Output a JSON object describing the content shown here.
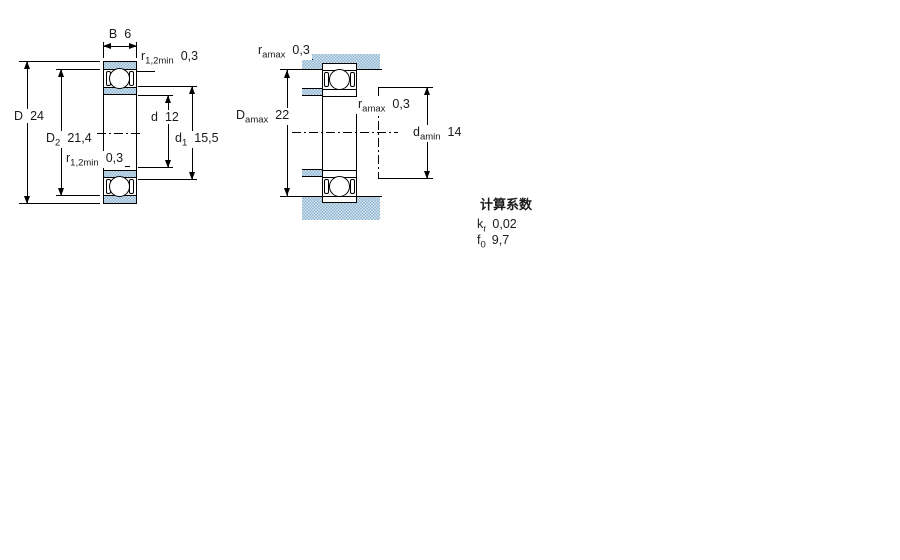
{
  "left_diagram": {
    "description": "bearing cross-section with shields",
    "width_label": {
      "sym": "B",
      "value": "6"
    },
    "outer_diameter": {
      "sym": "D",
      "value": "24"
    },
    "shoulder_diameter": {
      "sym": "D",
      "sub": "2",
      "value": "21,4"
    },
    "bore_diameter": {
      "sym": "d",
      "value": "12"
    },
    "recess_diameter": {
      "sym": "d",
      "sub": "1",
      "value": "15,5"
    },
    "fillet_top": {
      "sym": "r",
      "sub": "1,2min",
      "value": "0,3"
    },
    "fillet_bottom": {
      "sym": "r",
      "sub": "1,2min",
      "value": "0,3"
    }
  },
  "right_diagram": {
    "description": "bearing abutment dimensions with shaft and housing",
    "abutment_fillet_top": {
      "sym": "r",
      "sub": "amax",
      "value": "0,3"
    },
    "abutment_fillet_mid": {
      "sym": "r",
      "sub": "amax",
      "value": "0,3"
    },
    "housing_shoulder_diameter": {
      "sym": "D",
      "sub": "amax",
      "value": "22"
    },
    "shaft_shoulder_diameter": {
      "sym": "d",
      "sub": "amin",
      "value": "14"
    }
  },
  "calculation_factors": {
    "title": "计算系数",
    "factors": [
      {
        "sym": "k",
        "sub": "r",
        "value": "0,02"
      },
      {
        "sym": "f",
        "sub": "0",
        "value": "9,7"
      }
    ]
  },
  "colors": {
    "section_fill": "#9cbcd6",
    "line": "#000000",
    "background": "#ffffff"
  }
}
